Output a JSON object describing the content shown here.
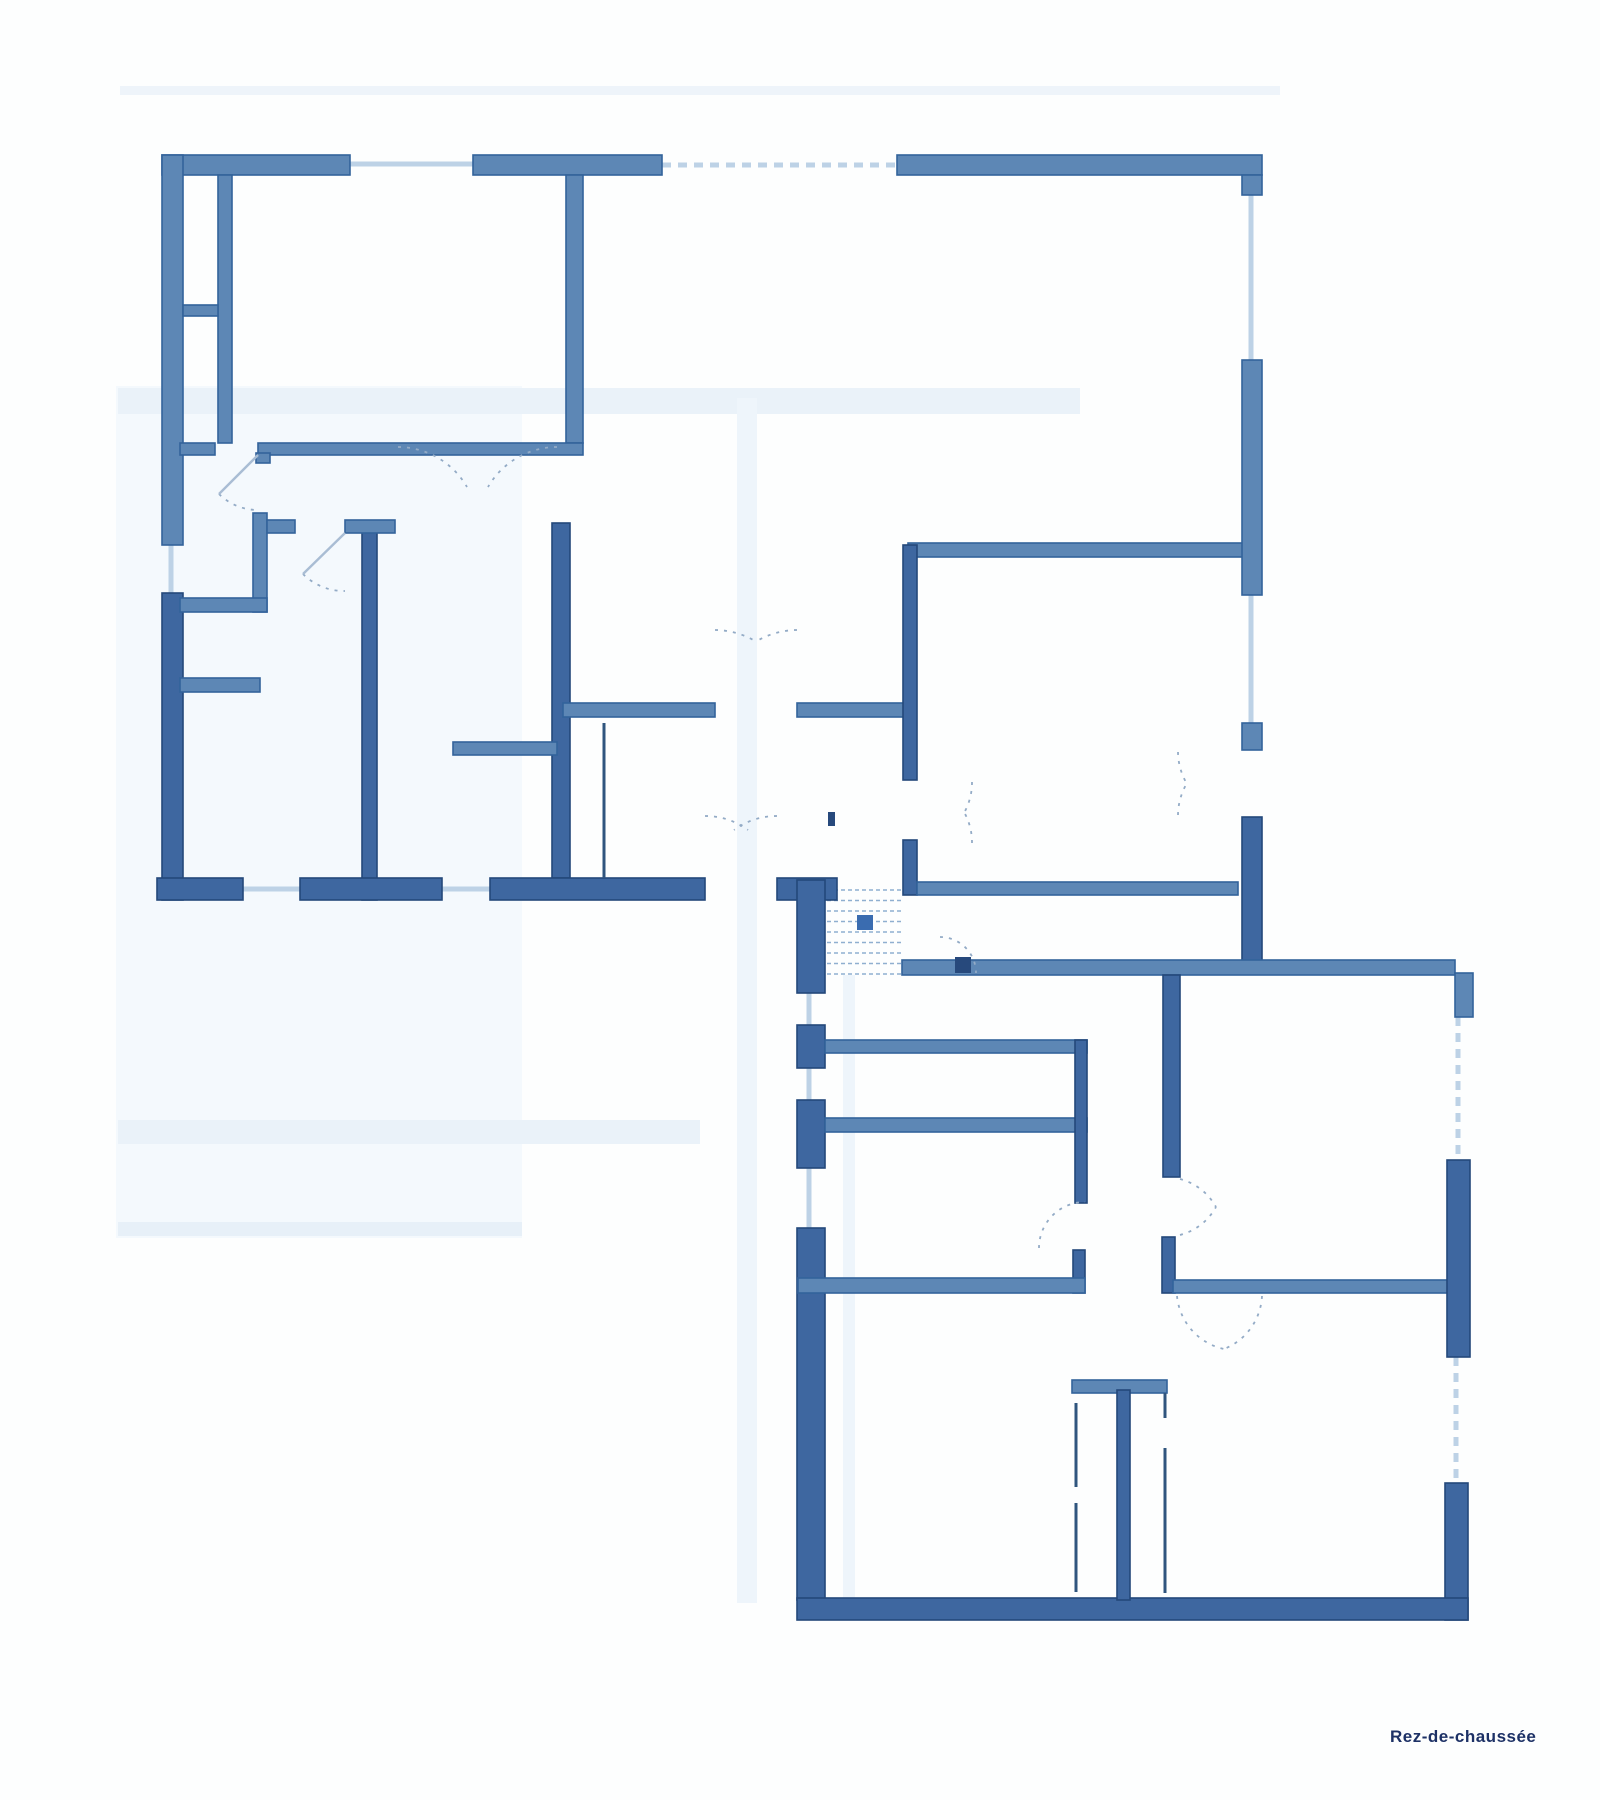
{
  "page": {
    "background": "#fdfefe",
    "label": {
      "text": "Rez-de-chaussée",
      "x": 1390,
      "y": 1742,
      "color": "#1d3166",
      "size": 17
    }
  },
  "plan": {
    "colors": {
      "wall_mid": "#5d87b5",
      "wall_mid_stroke": "#33639b",
      "wall_dark": "#3e67a0",
      "wall_dark_stroke": "#24487a",
      "window": "#bdd2e6",
      "arc": "#93abc6",
      "leaf": "#a9bdd4",
      "thin_wall": "#30557e",
      "stair_tread": "#8fafd0",
      "marker": "#3a6cb0",
      "mark_dark": "#27497c"
    },
    "artifacts": [
      {
        "x": 116,
        "y": 386,
        "w": 406,
        "h": 852,
        "color": "#f4f9fd"
      },
      {
        "x": 118,
        "y": 388,
        "w": 962,
        "h": 26,
        "color": "#eaf2f9"
      },
      {
        "x": 118,
        "y": 1120,
        "w": 582,
        "h": 24,
        "color": "#eaf2f9"
      },
      {
        "x": 118,
        "y": 1222,
        "w": 404,
        "h": 14,
        "color": "#e7f0f8"
      },
      {
        "x": 737,
        "y": 398,
        "w": 20,
        "h": 1205,
        "color": "#eef5fb"
      },
      {
        "x": 843,
        "y": 975,
        "w": 12,
        "h": 628,
        "color": "#eef5fb"
      },
      {
        "x": 120,
        "y": 86,
        "w": 1160,
        "h": 9,
        "color": "#eef4fa"
      }
    ],
    "walls": [
      {
        "x": 162,
        "y": 155,
        "w": 188,
        "h": 20,
        "shade": "mid"
      },
      {
        "x": 473,
        "y": 155,
        "w": 189,
        "h": 20,
        "shade": "mid"
      },
      {
        "x": 897,
        "y": 155,
        "w": 365,
        "h": 20,
        "shade": "mid"
      },
      {
        "x": 162,
        "y": 155,
        "w": 21,
        "h": 390,
        "shade": "mid"
      },
      {
        "x": 162,
        "y": 593,
        "w": 21,
        "h": 307,
        "shade": "dark"
      },
      {
        "x": 218,
        "y": 175,
        "w": 14,
        "h": 268,
        "shade": "mid"
      },
      {
        "x": 183,
        "y": 305,
        "w": 35,
        "h": 11,
        "shade": "mid"
      },
      {
        "x": 566,
        "y": 175,
        "w": 17,
        "h": 268,
        "shade": "mid"
      },
      {
        "x": 180,
        "y": 443,
        "w": 35,
        "h": 12,
        "shade": "mid"
      },
      {
        "x": 258,
        "y": 443,
        "w": 325,
        "h": 12,
        "shade": "mid"
      },
      {
        "x": 256,
        "y": 453,
        "w": 14,
        "h": 10,
        "shade": "mid"
      },
      {
        "x": 253,
        "y": 513,
        "w": 14,
        "h": 99,
        "shade": "mid"
      },
      {
        "x": 180,
        "y": 598,
        "w": 87,
        "h": 14,
        "shade": "mid"
      },
      {
        "x": 180,
        "y": 678,
        "w": 80,
        "h": 14,
        "shade": "mid"
      },
      {
        "x": 362,
        "y": 523,
        "w": 15,
        "h": 377,
        "shade": "dark"
      },
      {
        "x": 345,
        "y": 520,
        "w": 50,
        "h": 13,
        "shade": "mid"
      },
      {
        "x": 267,
        "y": 520,
        "w": 28,
        "h": 13,
        "shade": "mid"
      },
      {
        "x": 552,
        "y": 523,
        "w": 18,
        "h": 355,
        "shade": "dark"
      },
      {
        "x": 453,
        "y": 742,
        "w": 104,
        "h": 13,
        "shade": "mid"
      },
      {
        "x": 563,
        "y": 703,
        "w": 152,
        "h": 14,
        "shade": "mid"
      },
      {
        "x": 797,
        "y": 703,
        "w": 111,
        "h": 14,
        "shade": "mid"
      },
      {
        "x": 908,
        "y": 543,
        "w": 335,
        "h": 14,
        "shade": "mid"
      },
      {
        "x": 903,
        "y": 545,
        "w": 14,
        "h": 235,
        "shade": "dark"
      },
      {
        "x": 903,
        "y": 840,
        "w": 14,
        "h": 55,
        "shade": "dark"
      },
      {
        "x": 917,
        "y": 882,
        "w": 321,
        "h": 13,
        "shade": "mid"
      },
      {
        "x": 157,
        "y": 878,
        "w": 86,
        "h": 22,
        "shade": "dark"
      },
      {
        "x": 300,
        "y": 878,
        "w": 142,
        "h": 22,
        "shade": "dark"
      },
      {
        "x": 490,
        "y": 878,
        "w": 215,
        "h": 22,
        "shade": "dark"
      },
      {
        "x": 777,
        "y": 878,
        "w": 60,
        "h": 22,
        "shade": "dark"
      },
      {
        "x": 1242,
        "y": 175,
        "w": 20,
        "h": 20,
        "shade": "mid"
      },
      {
        "x": 1242,
        "y": 360,
        "w": 20,
        "h": 235,
        "shade": "mid"
      },
      {
        "x": 1242,
        "y": 723,
        "w": 20,
        "h": 27,
        "shade": "mid"
      },
      {
        "x": 1242,
        "y": 817,
        "w": 20,
        "h": 155,
        "shade": "dark"
      },
      {
        "x": 797,
        "y": 880,
        "w": 28,
        "h": 113,
        "shade": "dark"
      },
      {
        "x": 797,
        "y": 1025,
        "w": 28,
        "h": 43,
        "shade": "dark"
      },
      {
        "x": 797,
        "y": 1100,
        "w": 28,
        "h": 68,
        "shade": "dark"
      },
      {
        "x": 797,
        "y": 1228,
        "w": 28,
        "h": 372,
        "shade": "dark"
      },
      {
        "x": 902,
        "y": 960,
        "w": 553,
        "h": 15,
        "shade": "mid"
      },
      {
        "x": 1455,
        "y": 973,
        "w": 18,
        "h": 44,
        "shade": "mid"
      },
      {
        "x": 825,
        "y": 1040,
        "w": 262,
        "h": 13,
        "shade": "mid"
      },
      {
        "x": 825,
        "y": 1118,
        "w": 262,
        "h": 14,
        "shade": "mid"
      },
      {
        "x": 1075,
        "y": 1040,
        "w": 12,
        "h": 163,
        "shade": "dark"
      },
      {
        "x": 1073,
        "y": 1250,
        "w": 12,
        "h": 43,
        "shade": "dark"
      },
      {
        "x": 798,
        "y": 1278,
        "w": 287,
        "h": 15,
        "shade": "mid"
      },
      {
        "x": 1163,
        "y": 975,
        "w": 17,
        "h": 202,
        "shade": "dark"
      },
      {
        "x": 1162,
        "y": 1237,
        "w": 13,
        "h": 56,
        "shade": "dark"
      },
      {
        "x": 1173,
        "y": 1280,
        "w": 277,
        "h": 13,
        "shade": "mid"
      },
      {
        "x": 1447,
        "y": 1160,
        "w": 23,
        "h": 197,
        "shade": "dark"
      },
      {
        "x": 1445,
        "y": 1483,
        "w": 23,
        "h": 137,
        "shade": "dark"
      },
      {
        "x": 797,
        "y": 1598,
        "w": 671,
        "h": 22,
        "shade": "dark"
      },
      {
        "x": 1072,
        "y": 1380,
        "w": 95,
        "h": 13,
        "shade": "mid"
      },
      {
        "x": 1117,
        "y": 1390,
        "w": 13,
        "h": 210,
        "shade": "dark"
      }
    ],
    "thin_walls": [
      {
        "x1": 604,
        "y1": 723,
        "x2": 604,
        "y2": 878
      },
      {
        "x1": 1076,
        "y1": 1403,
        "x2": 1076,
        "y2": 1487
      },
      {
        "x1": 1076,
        "y1": 1503,
        "x2": 1076,
        "y2": 1592
      },
      {
        "x1": 1165,
        "y1": 1393,
        "x2": 1165,
        "y2": 1418
      },
      {
        "x1": 1165,
        "y1": 1448,
        "x2": 1165,
        "y2": 1593
      }
    ],
    "windows": [
      {
        "x1": 350,
        "y1": 164,
        "x2": 473,
        "y2": 164,
        "dash": false
      },
      {
        "x1": 662,
        "y1": 165,
        "x2": 897,
        "y2": 165,
        "dash": true
      },
      {
        "x1": 1251,
        "y1": 195,
        "x2": 1251,
        "y2": 360,
        "dash": false
      },
      {
        "x1": 1251,
        "y1": 595,
        "x2": 1251,
        "y2": 723,
        "dash": false
      },
      {
        "x1": 171,
        "y1": 545,
        "x2": 171,
        "y2": 593,
        "dash": false
      },
      {
        "x1": 243,
        "y1": 889,
        "x2": 300,
        "y2": 889,
        "dash": false
      },
      {
        "x1": 442,
        "y1": 889,
        "x2": 490,
        "y2": 889,
        "dash": false
      },
      {
        "x1": 809,
        "y1": 993,
        "x2": 809,
        "y2": 1025,
        "dash": false
      },
      {
        "x1": 809,
        "y1": 1068,
        "x2": 809,
        "y2": 1100,
        "dash": false
      },
      {
        "x1": 809,
        "y1": 1168,
        "x2": 809,
        "y2": 1228,
        "dash": false
      },
      {
        "x1": 1458,
        "y1": 1017,
        "x2": 1458,
        "y2": 1160,
        "dash": true
      },
      {
        "x1": 1456,
        "y1": 1357,
        "x2": 1456,
        "y2": 1483,
        "dash": true
      }
    ],
    "stairs": {
      "x1": 827,
      "x2": 903,
      "y_start": 890,
      "y_end": 974,
      "count": 9,
      "marker": {
        "x": 857,
        "y": 915,
        "w": 16,
        "h": 15
      }
    },
    "door_arcs": [
      {
        "d": "M219,494 A55,55 0 0,0 258,510"
      },
      {
        "d": "M303,574 A58,58 0 0,0 345,591"
      },
      {
        "d": "M398,447 A80,80 0 0,1 467,487"
      },
      {
        "d": "M557,447 A80,80 0 0,0 488,487"
      },
      {
        "d": "M715,630 A80,80 0 0,1 755,641"
      },
      {
        "d": "M797,630 A80,80 0 0,0 757,641"
      },
      {
        "d": "M972,782 A62,62 0 0,1 964,813"
      },
      {
        "d": "M972,843 A62,62 0 0,0 964,812"
      },
      {
        "d": "M1178,752 A64,64 0 0,0 1187,784"
      },
      {
        "d": "M1178,815 A64,64 0 0,1 1187,783"
      },
      {
        "d": "M705,816 A72,72 0 0,1 748,830"
      },
      {
        "d": "M777,816 A72,72 0 0,0 734,830"
      },
      {
        "d": "M940,937 A36,36 0 0,1 976,973"
      },
      {
        "d": "M1039,1248 A46,46 0 0,1 1085,1202"
      },
      {
        "d": "M1180,1179 A58,58 0 0,1 1216,1207"
      },
      {
        "d": "M1180,1235 A58,58 0 0,0 1216,1207"
      },
      {
        "d": "M1177,1296 A60,60 0 0,0 1224,1349"
      },
      {
        "d": "M1262,1296 A60,60 0 0,1 1224,1349"
      }
    ],
    "door_leaves": [
      {
        "x1": 258,
        "y1": 455,
        "x2": 219,
        "y2": 494
      },
      {
        "x1": 345,
        "y1": 533,
        "x2": 303,
        "y2": 574
      }
    ],
    "marks": [
      {
        "x": 828,
        "y": 812,
        "w": 7,
        "h": 14
      },
      {
        "x": 955,
        "y": 957,
        "w": 16,
        "h": 16
      }
    ]
  }
}
